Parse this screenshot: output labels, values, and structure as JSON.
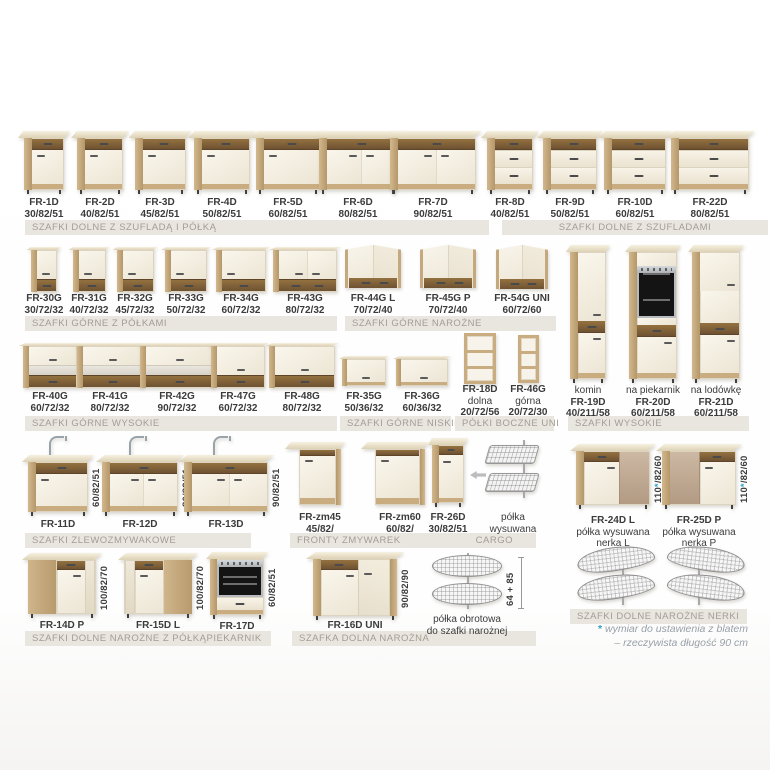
{
  "banners": {
    "b1": "SZAFKI DOLNE Z SZUFLADĄ I PÓŁKĄ",
    "b2": "SZAFKI DOLNE Z SZUFLADAMI",
    "b3": "SZAFKI GÓRNE Z PÓŁKAMI",
    "b4": "SZAFKI GÓRNE NAROŻNE",
    "b5": "SZAFKI GÓRNE WYSOKIE",
    "b6": "SZAFKI GÓRNE NISKIE",
    "b7": "PÓŁKI BOCZNE UNI",
    "b8": "SZAFKI WYSOKIE",
    "b9": "SZAFKI ZLEWOZMYWAKOWE",
    "b10": "FRONTY ZMYWAREK",
    "b11": "CARGO",
    "b12": "SZAFKI DOLNE NAROŻNE Z PÓŁKĄ",
    "b13": "PIEKARNIK",
    "b14": "SZAFKA DOLNA NAROŻNA",
    "b15": "SZAFKI DOLNE NAROŻNE NERKI"
  },
  "products": [
    {
      "id": "fr1d",
      "code": "FR-1D",
      "dims": "30/82/51"
    },
    {
      "id": "fr2d",
      "code": "FR-2D",
      "dims": "40/82/51"
    },
    {
      "id": "fr3d",
      "code": "FR-3D",
      "dims": "45/82/51"
    },
    {
      "id": "fr4d",
      "code": "FR-4D",
      "dims": "50/82/51"
    },
    {
      "id": "fr5d",
      "code": "FR-5D",
      "dims": "60/82/51"
    },
    {
      "id": "fr6d",
      "code": "FR-6D",
      "dims": "80/82/51"
    },
    {
      "id": "fr7d",
      "code": "FR-7D",
      "dims": "90/82/51"
    },
    {
      "id": "fr8d",
      "code": "FR-8D",
      "dims": "40/82/51"
    },
    {
      "id": "fr9d",
      "code": "FR-9D",
      "dims": "50/82/51"
    },
    {
      "id": "fr10d",
      "code": "FR-10D",
      "dims": "60/82/51"
    },
    {
      "id": "fr22d",
      "code": "FR-22D",
      "dims": "80/82/51"
    },
    {
      "id": "fr30g",
      "code": "FR-30G",
      "dims": "30/72/32"
    },
    {
      "id": "fr31g",
      "code": "FR-31G",
      "dims": "40/72/32"
    },
    {
      "id": "fr32g",
      "code": "FR-32G",
      "dims": "45/72/32"
    },
    {
      "id": "fr33g",
      "code": "FR-33G",
      "dims": "50/72/32"
    },
    {
      "id": "fr34g",
      "code": "FR-34G",
      "dims": "60/72/32"
    },
    {
      "id": "fr43g",
      "code": "FR-43G",
      "dims": "80/72/32"
    },
    {
      "id": "fr44g",
      "code": "FR-44G L",
      "dims": "70/72/40"
    },
    {
      "id": "fr45g",
      "code": "FR-45G P",
      "dims": "70/72/40"
    },
    {
      "id": "fr54g",
      "code": "FR-54G UNI",
      "dims": "60/72/60"
    },
    {
      "id": "fr19d",
      "caption_top": "komin",
      "code": "FR-19D",
      "dims": "40/211/58"
    },
    {
      "id": "fr20d",
      "caption_top": "na piekarnik",
      "code": "FR-20D",
      "dims": "60/211/58"
    },
    {
      "id": "fr21d",
      "caption_top": "na lodówkę",
      "code": "FR-21D",
      "dims": "60/211/58"
    },
    {
      "id": "fr40g",
      "code": "FR-40G",
      "dims": "60/72/32"
    },
    {
      "id": "fr41g",
      "code": "FR-41G",
      "dims": "80/72/32"
    },
    {
      "id": "fr42g",
      "code": "FR-42G",
      "dims": "90/72/32"
    },
    {
      "id": "fr47g",
      "code": "FR-47G",
      "dims": "60/72/32"
    },
    {
      "id": "fr48g",
      "code": "FR-48G",
      "dims": "80/72/32"
    },
    {
      "id": "fr35g",
      "code": "FR-35G",
      "dims": "50/36/32"
    },
    {
      "id": "fr36g",
      "code": "FR-36G",
      "dims": "60/36/32"
    },
    {
      "id": "fr18d",
      "code": "FR-18D",
      "caption": "dolna",
      "dims": "20/72/56"
    },
    {
      "id": "fr46g",
      "code": "FR-46G",
      "caption": "górna",
      "dims": "20/72/30"
    },
    {
      "id": "fr11d",
      "code": "FR-11D",
      "dims": "60/82/51"
    },
    {
      "id": "fr12d",
      "code": "FR-12D",
      "dims": "80/82/51"
    },
    {
      "id": "fr13d",
      "code": "FR-13D",
      "dims": "90/82/51"
    },
    {
      "id": "frzm45",
      "code": "FR-zm45",
      "dims": "45/82/"
    },
    {
      "id": "frzm60",
      "code": "FR-zm60",
      "dims": "60/82/"
    },
    {
      "id": "fr26d",
      "code": "FR-26D",
      "dims": "30/82/51"
    },
    {
      "id": "cargo",
      "caption": "półka",
      "caption2": "wysuwana"
    },
    {
      "id": "fr24d",
      "code": "FR-24D L",
      "caption": "półka wysuwana",
      "caption2": "nerka L",
      "dims": "110*/82/60"
    },
    {
      "id": "fr25d",
      "code": "FR-25D P",
      "caption": "półka wysuwana",
      "caption2": "nerka P",
      "dims": "110*/82/60"
    },
    {
      "id": "fr14d",
      "code": "FR-14D P",
      "dims": "100/82/70"
    },
    {
      "id": "fr15d",
      "code": "FR-15D L",
      "dims": "100/82/70"
    },
    {
      "id": "fr17d",
      "code": "FR-17D",
      "dims": "60/82/51"
    },
    {
      "id": "fr16d",
      "code": "FR-16D UNI",
      "dims": "90/82/90"
    },
    {
      "id": "carousel",
      "caption": "półka obrotowa",
      "caption2": "do szafki narożnej",
      "dims": "64 + 85"
    },
    {
      "id": "nerka_l"
    },
    {
      "id": "nerka_p"
    }
  ],
  "footnote": {
    "asterisk": "*",
    "line1": "wymiar do ustawienia z blatem",
    "line2": "– rzeczywista długość 90 cm"
  },
  "colors": {
    "wood": "#c9ad82",
    "wood_dark": "#7a5a38",
    "front_cream": "#f4efe4",
    "banner_bg": "#e9e6e0",
    "banner_text": "#a39d94",
    "label_text": "#3b3b3b",
    "asterisk_accent": "#2f9fc4"
  }
}
